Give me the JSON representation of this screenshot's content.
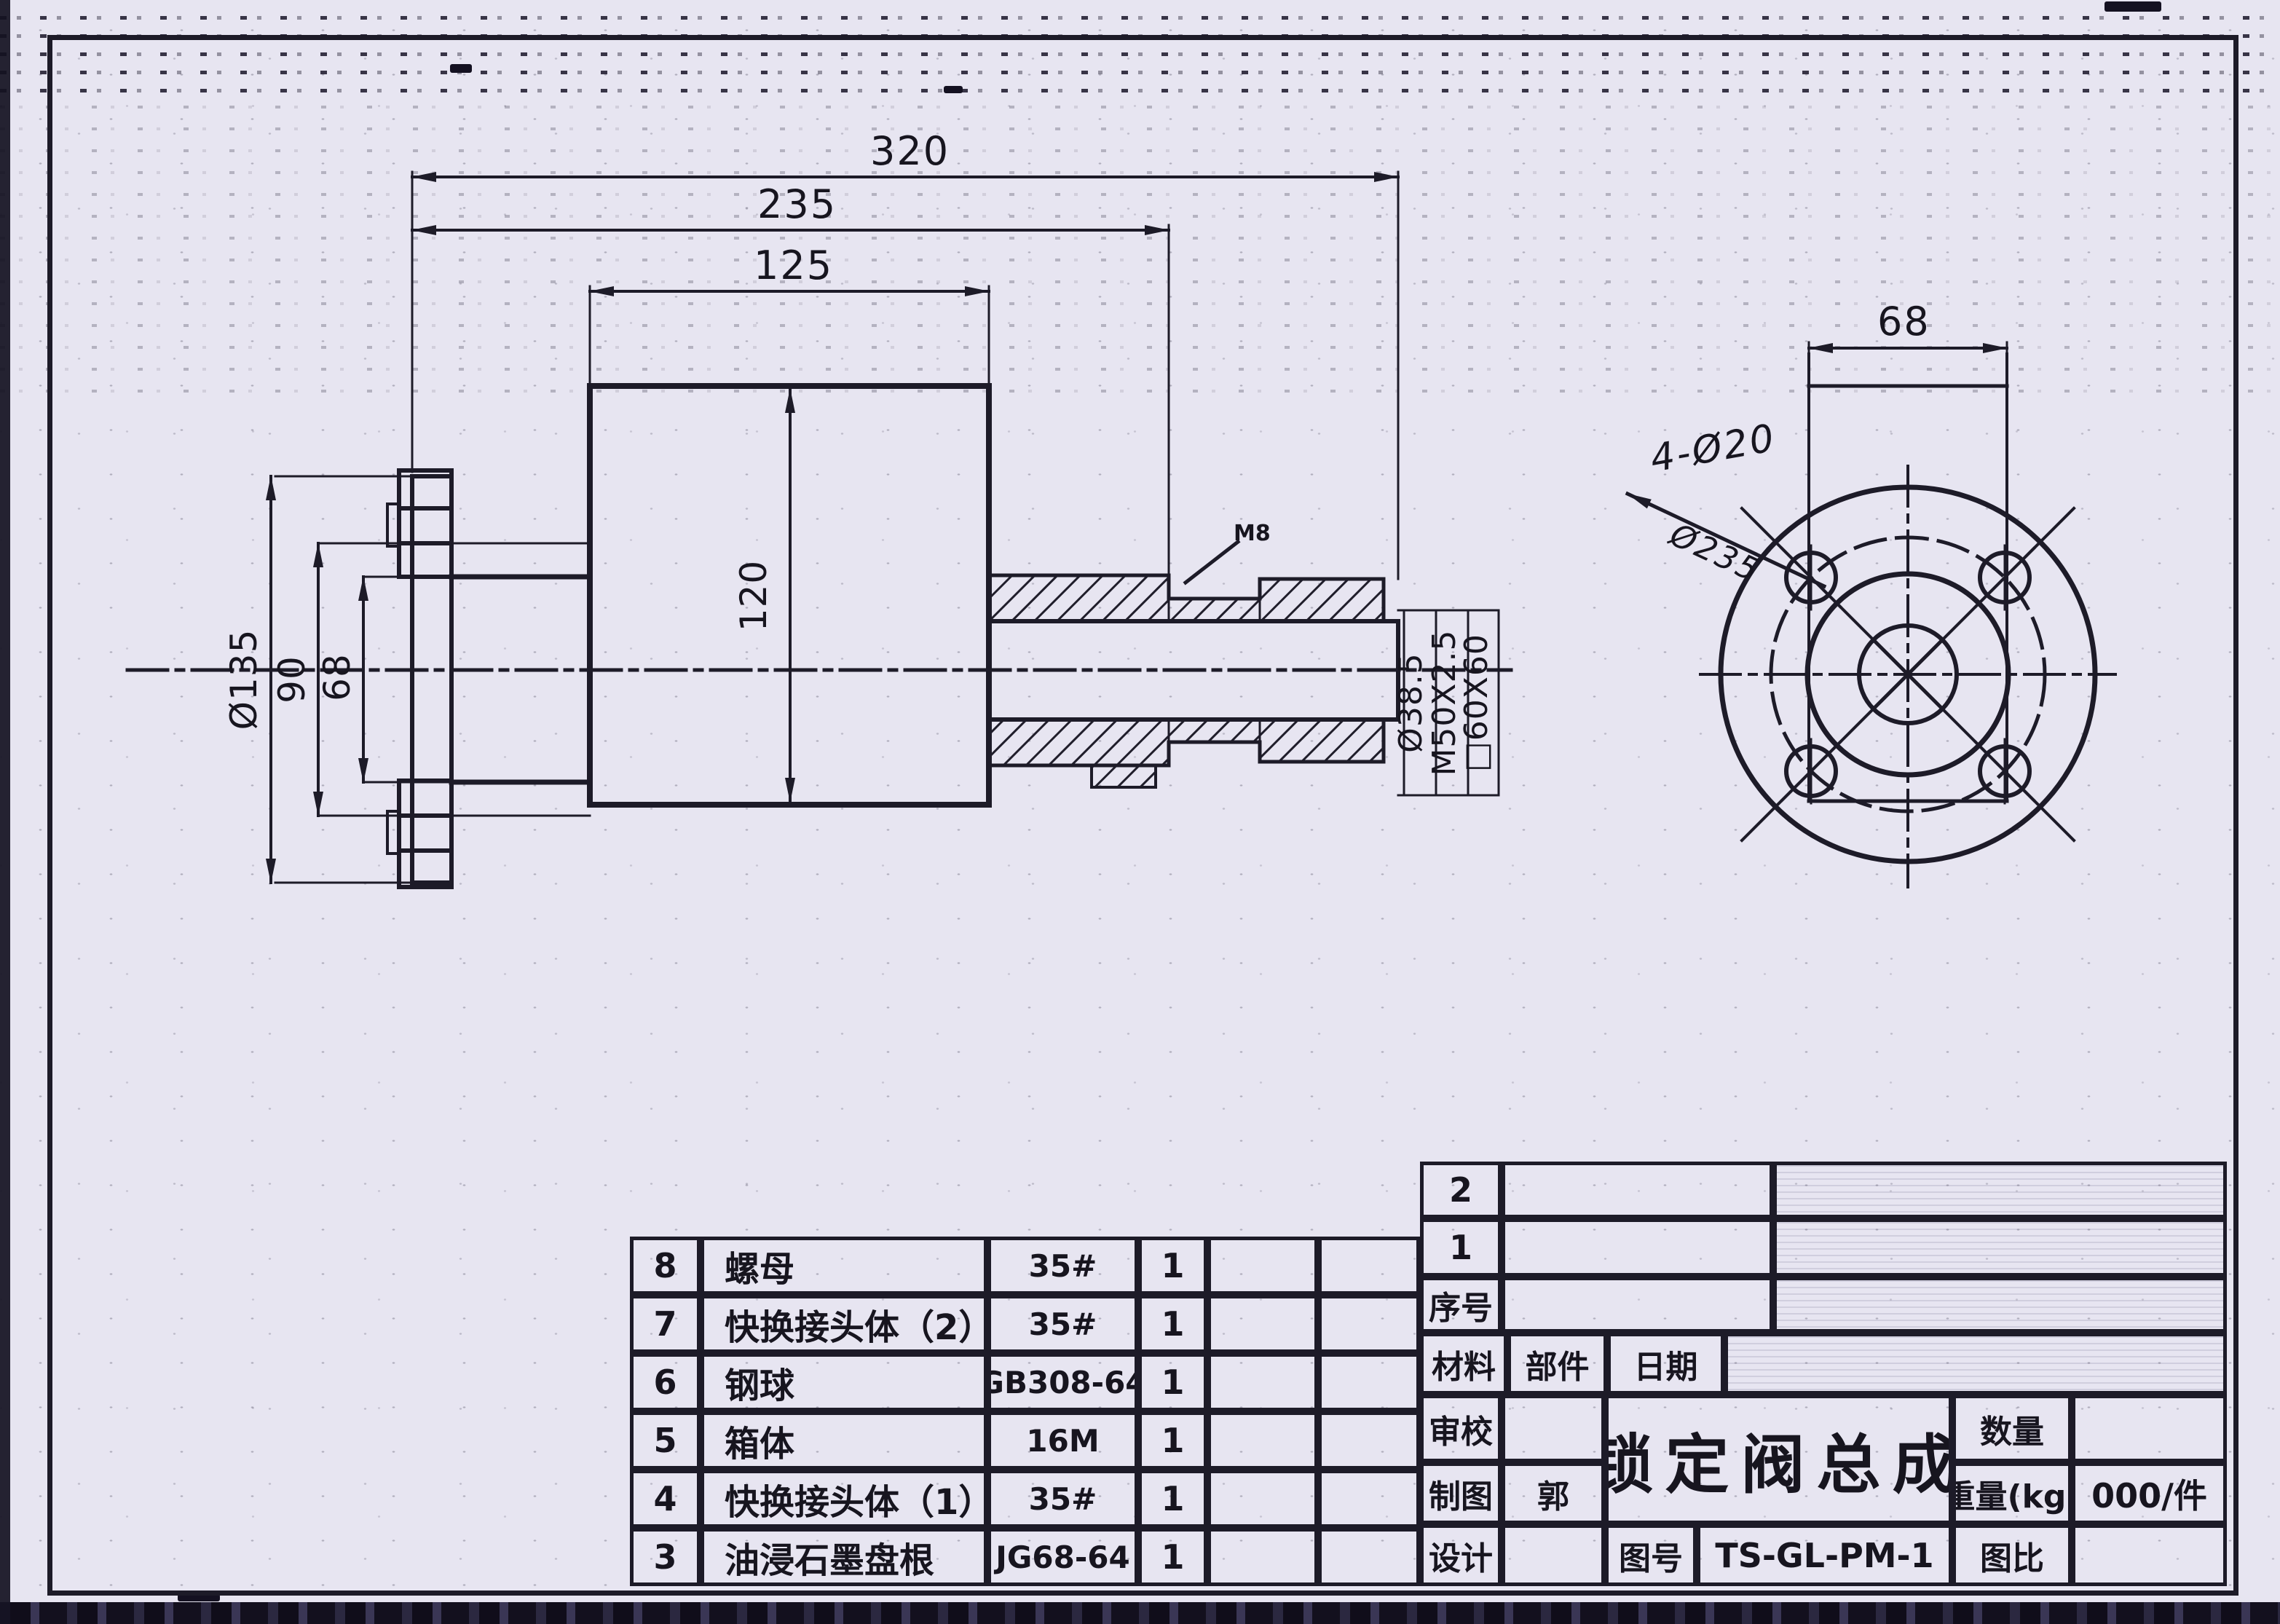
{
  "colors": {
    "paper": "#e7e5f1",
    "ink": "#1d1b28"
  },
  "drawing": {
    "top_dims": {
      "d320": "320",
      "d235": "235",
      "d125": "125"
    },
    "left_dims": {
      "d135": "Ø135",
      "d90": "90",
      "d68": "68"
    },
    "body_dim": {
      "d120": "120"
    },
    "right_labels": {
      "bore": "Ø38.5",
      "thread": "M50X2.5",
      "square": "□60X60",
      "m8": "M8"
    },
    "end_view": {
      "width": "68",
      "holes": "4-Ø20",
      "bolt_circle": "Ø235"
    }
  },
  "bom": {
    "rows": [
      {
        "no": "8",
        "name": "螺母",
        "spec": "35#",
        "qty": "1"
      },
      {
        "no": "7",
        "name": "快换接头体（2）",
        "spec": "35#",
        "qty": "1"
      },
      {
        "no": "6",
        "name": "钢球",
        "spec": "GB308-64",
        "qty": "1"
      },
      {
        "no": "5",
        "name": "箱体",
        "spec": "16M",
        "qty": "1"
      },
      {
        "no": "4",
        "name": "快换接头体（1）",
        "spec": "35#",
        "qty": "1"
      },
      {
        "no": "3",
        "name": "油浸石墨盘根",
        "spec": "JG68-64",
        "qty": "1"
      }
    ]
  },
  "title_block": {
    "row_2": "2",
    "row_1": "1",
    "serial_label": "序号",
    "material_label": "材料",
    "part_label": "部件",
    "date_label": "日期",
    "check_label": "审校",
    "draft_label": "制图",
    "draft_value": "郭",
    "design_label": "设计",
    "title": "锁定阀总成",
    "qty_label": "数量",
    "weight_label": "重量(kg)",
    "weight_value": "000/件",
    "drawing_no_label": "图号",
    "drawing_no": "TS-GL-PM-1",
    "scale_label": "图比"
  }
}
